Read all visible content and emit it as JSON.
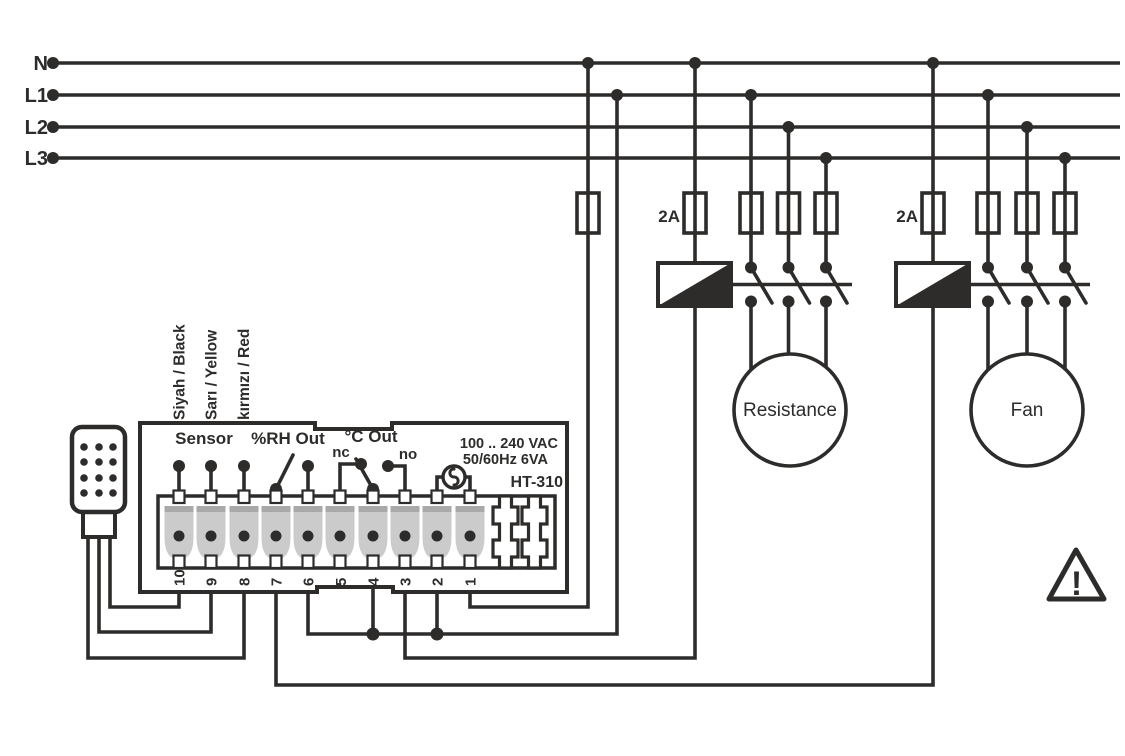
{
  "colors": {
    "ink": "#2d2c2b",
    "terminal_fill": "#cbcbcb",
    "terminal_top": "#a9a9a9",
    "background": "#ffffff"
  },
  "power_bus": {
    "n": "N",
    "l1": "L1",
    "l2": "L2",
    "l3": "L3"
  },
  "fuses": {
    "resistance_coil_fuse": "2A",
    "fan_coil_fuse": "2A"
  },
  "loads": {
    "resistance": "Resistance",
    "fan": "Fan"
  },
  "controller": {
    "model": "HT-310",
    "rating_line1": "100 .. 240 VAC",
    "rating_line2": "50/60Hz 6VA",
    "labels": {
      "sensor": "Sensor",
      "rh_out": "%RH Out",
      "c_out": "°C Out",
      "nc": "nc",
      "no": "no"
    },
    "terminal_numbers": [
      "10",
      "9",
      "8",
      "7",
      "6",
      "5",
      "4",
      "3",
      "2",
      "1"
    ]
  },
  "sensor": {
    "wire_black": "Siyah / Black",
    "wire_yellow": "Sarı / Yellow",
    "wire_red": "kırmızı / Red"
  },
  "icons": {
    "warning": "!"
  }
}
